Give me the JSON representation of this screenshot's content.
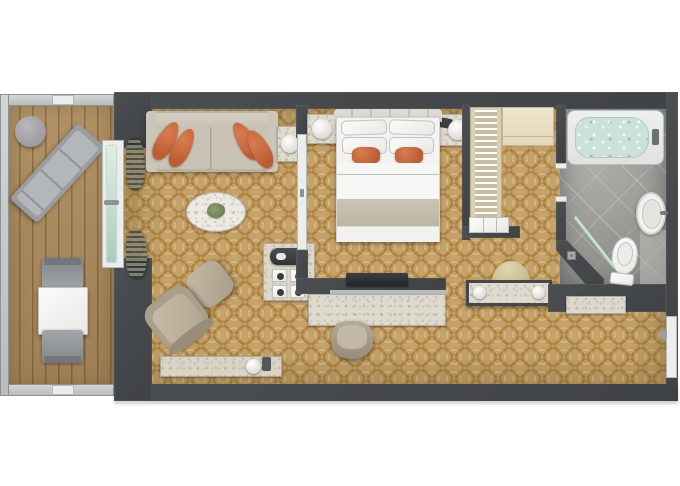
{
  "plan_title": "Suite with balcony floor plan",
  "palette": {
    "wall": "#474a4c",
    "carpet": "#c3a26b",
    "carpet_line": "#a8813d",
    "deck_wood": "#ad8f63",
    "marble": "#e0dbce",
    "bath_floor": "#9d9d99",
    "tub_water": "#cde3dd",
    "accent_orange": "#c4673c",
    "sofa": "#c6c0b3",
    "bed_runner": "#c9bfae",
    "glass": "#cfe2d6"
  },
  "rooms": [
    {
      "name": "balcony",
      "items": [
        "lounge-chair",
        "round-side-table",
        "dining-table",
        "dining-chairs",
        "railing"
      ]
    },
    {
      "name": "living-room",
      "items": [
        "sofa",
        "accent-pillows",
        "oval-coffee-table",
        "armchair",
        "ottoman",
        "lamp-side-table",
        "console-bench",
        "coffee-station",
        "curtains",
        "sliding-glass-door"
      ]
    },
    {
      "name": "bedroom",
      "items": [
        "double-bed",
        "orange-pillows",
        "nightstands",
        "table-lamps",
        "telephone",
        "tv",
        "desk",
        "desk-chair"
      ]
    },
    {
      "name": "walk-in-closet",
      "items": [
        "wardrobe-with-hangers",
        "cabinet",
        "drawer-unit"
      ]
    },
    {
      "name": "dressing-area",
      "items": [
        "vanity-table",
        "stool"
      ]
    },
    {
      "name": "bathroom",
      "items": [
        "bathtub",
        "washbasin",
        "toilet",
        "walk-in-shower",
        "glass-screen",
        "floor-drain"
      ]
    },
    {
      "name": "entry-hall",
      "items": [
        "entry-door",
        "console-shelf"
      ]
    }
  ],
  "labels": {
    "plan": "Suite with balcony floor plan",
    "balcony": "Balcony",
    "deck": "Wood deck",
    "railing": "Balcony railing",
    "lounger": "Lounge chair",
    "round_table": "Round side table",
    "patio_table": "Patio dining table",
    "patio_chair": "Patio chair",
    "glass_door": "Sliding glass door",
    "curtain": "Curtain",
    "living": "Living room",
    "sofa": "Sofa",
    "pillow": "Accent pillow",
    "coffee_table": "Oval coffee table",
    "plant": "Table plant",
    "armchair": "Armchair",
    "ottoman": "Ottoman",
    "side_table": "Side table with lamp",
    "bench": "Console bench",
    "coffee_station": "Coffee station",
    "coffee_machine": "Coffee machine",
    "cups": "Cups",
    "desk": "Desk",
    "desk_chair": "Desk chair",
    "tv": "TV",
    "bedroom": "Bedroom",
    "bed": "Double bed",
    "headboard": "Headboard",
    "nightstand": "Nightstand",
    "lamp": "Table lamp",
    "phone": "Telephone",
    "runner": "Bed runner",
    "closet": "Walk-in closet",
    "wardrobe": "Wardrobe with hangers",
    "cabinet": "Cabinet",
    "drawers": "Drawer unit",
    "vanity": "Vanity table",
    "stool": "Vanity stool",
    "bathroom": "Bathroom",
    "bathtub": "Bathtub",
    "sink": "Washbasin",
    "toilet": "Toilet",
    "shower": "Walk-in shower",
    "glass_screen": "Shower glass screen",
    "drain": "Floor drain",
    "hall": "Entry hall",
    "hall_console": "Console shelf",
    "entry_door": "Entry door",
    "partition_door": "Bedroom sliding door",
    "bath_door": "Bathroom door"
  }
}
